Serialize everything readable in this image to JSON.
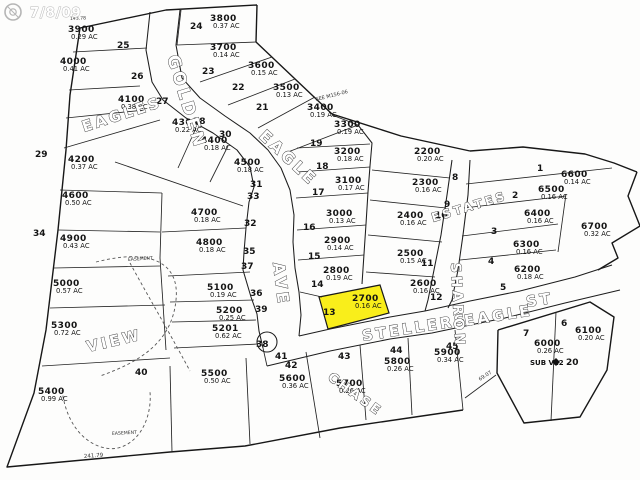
{
  "watermark": {
    "text": "7/8/09"
  },
  "colors": {
    "highlight": "#f9ee1b",
    "lines": "#1a1a1a",
    "watermark": "#b5b5b5"
  },
  "map": {
    "highlighted_lot": "2700",
    "streets": [
      {
        "label": "GOLDEN"
      },
      {
        "label": "EAGLE"
      },
      {
        "label": "AVE"
      },
      {
        "label": "STELLERS"
      },
      {
        "label": "EAGLE"
      },
      {
        "label": "ST"
      },
      {
        "label": "SHARON"
      },
      {
        "label": "ESTATES"
      }
    ],
    "areas": [
      {
        "label": "EAGLES"
      },
      {
        "label": "VIEW"
      },
      {
        "label": "CHASE"
      }
    ],
    "annotations": [
      {
        "text": "EASEMENT"
      },
      {
        "text": "EASEMENT"
      },
      {
        "text": "SEE M156-06"
      },
      {
        "text": "SUB V22"
      },
      {
        "text": "241.79"
      },
      {
        "text": "69.07"
      },
      {
        "text": "143.78"
      }
    ],
    "corner_numbers": [
      "24",
      "25",
      "26",
      "27",
      "23",
      "22",
      "21",
      "28",
      "30",
      "31",
      "29",
      "33",
      "32",
      "35",
      "37",
      "34",
      "36",
      "39",
      "38",
      "40",
      "19",
      "18",
      "17",
      "16",
      "15",
      "14",
      "13",
      "8",
      "9",
      "10",
      "11",
      "12",
      "1",
      "2",
      "3",
      "4",
      "5",
      "6",
      "7",
      "42",
      "41",
      "43",
      "44",
      "45",
      "20"
    ],
    "lots": [
      {
        "id": "3800",
        "area": "0.37 AC"
      },
      {
        "id": "3900",
        "area": "0.29 AC"
      },
      {
        "id": "4000",
        "area": "0.41 AC"
      },
      {
        "id": "4100",
        "area": "0.38 AC"
      },
      {
        "id": "3700",
        "area": "0.14 AC"
      },
      {
        "id": "3600",
        "area": "0.15 AC"
      },
      {
        "id": "3500",
        "area": "0.13 AC"
      },
      {
        "id": "3400",
        "area": "0.19 AC"
      },
      {
        "id": "4200",
        "area": "0.37 AC"
      },
      {
        "id": "4300",
        "area": "0.22 AC"
      },
      {
        "id": "4400",
        "area": "0.18 AC"
      },
      {
        "id": "4500",
        "area": "0.18 AC"
      },
      {
        "id": "4600",
        "area": "0.50 AC"
      },
      {
        "id": "4700",
        "area": "0.18 AC"
      },
      {
        "id": "4800",
        "area": "0.18 AC"
      },
      {
        "id": "4900",
        "area": "0.43 AC"
      },
      {
        "id": "5000",
        "area": "0.57 AC"
      },
      {
        "id": "5100",
        "area": "0.19 AC"
      },
      {
        "id": "5200",
        "area": "0.25 AC"
      },
      {
        "id": "5201",
        "area": "0.62 AC"
      },
      {
        "id": "5300",
        "area": "0.72 AC"
      },
      {
        "id": "5400",
        "area": "0.99 AC"
      },
      {
        "id": "5500",
        "area": "0.50 AC"
      },
      {
        "id": "5600",
        "area": "0.36 AC"
      },
      {
        "id": "5700",
        "area": "0.26 AC"
      },
      {
        "id": "5800",
        "area": "0.26 AC"
      },
      {
        "id": "5900",
        "area": "0.34 AC"
      },
      {
        "id": "6000",
        "area": "0.26 AC"
      },
      {
        "id": "6100",
        "area": "0.20 AC"
      },
      {
        "id": "6200",
        "area": "0.18 AC"
      },
      {
        "id": "6300",
        "area": "0.16 AC"
      },
      {
        "id": "6400",
        "area": "0.16 AC"
      },
      {
        "id": "6500",
        "area": "0.16 AC"
      },
      {
        "id": "6600",
        "area": "0.14 AC"
      },
      {
        "id": "6700",
        "area": "0.32 AC"
      },
      {
        "id": "3300",
        "area": "0.19 AC"
      },
      {
        "id": "3200",
        "area": "0.18 AC"
      },
      {
        "id": "3100",
        "area": "0.17 AC"
      },
      {
        "id": "3000",
        "area": "0.13 AC"
      },
      {
        "id": "2900",
        "area": "0.14 AC"
      },
      {
        "id": "2800",
        "area": "0.19 AC"
      },
      {
        "id": "2700",
        "area": "0.16 AC"
      },
      {
        "id": "2600",
        "area": "0.16 AC"
      },
      {
        "id": "2500",
        "area": "0.15 AC"
      },
      {
        "id": "2400",
        "area": "0.16 AC"
      },
      {
        "id": "2300",
        "area": "0.16 AC"
      },
      {
        "id": "2200",
        "area": "0.20 AC"
      }
    ]
  }
}
